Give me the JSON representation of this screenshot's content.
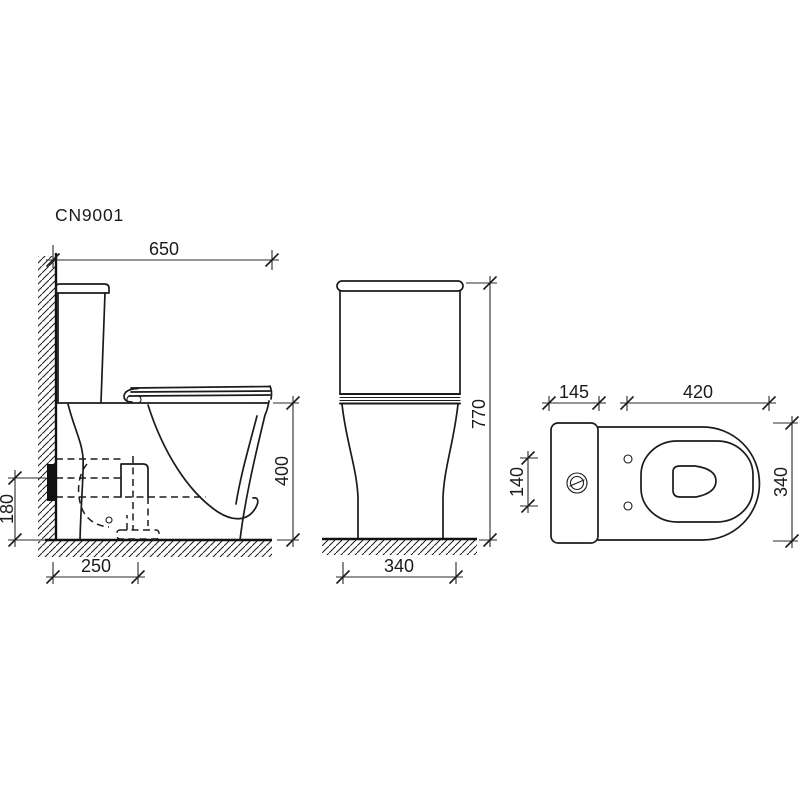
{
  "title": {
    "model": "CN9001"
  },
  "colors": {
    "line": "#1b1b1b",
    "background": "#ffffff"
  },
  "views": {
    "side": {
      "dims": {
        "depth_total": "650",
        "rim_height": "400",
        "outlet_height": "180",
        "outlet_offset": "250"
      }
    },
    "front": {
      "dims": {
        "height_total": "770",
        "base_width": "340"
      }
    },
    "top": {
      "dims": {
        "tank_depth": "145",
        "bowl_length": "420",
        "tank_side": "140",
        "width_total": "340"
      }
    }
  }
}
